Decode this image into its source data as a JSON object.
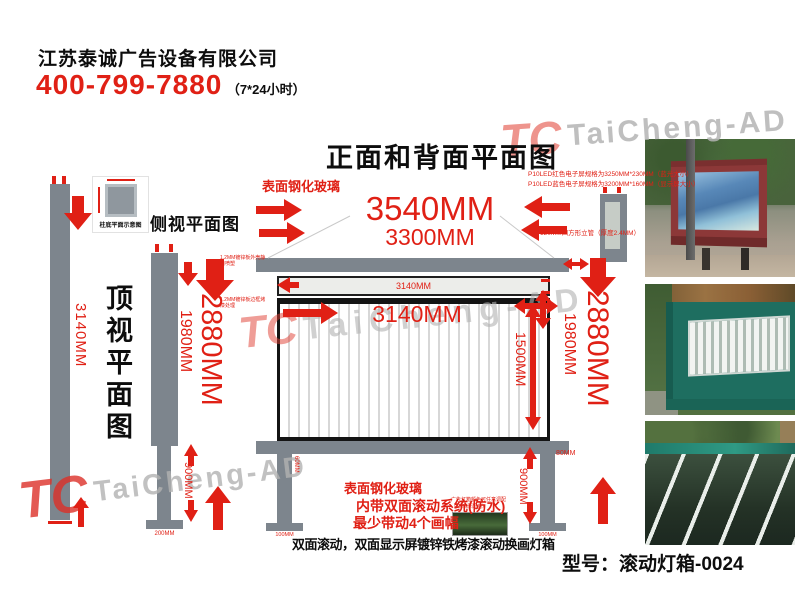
{
  "colors": {
    "accent_red": "#e02015",
    "steel_gray": "#7d858d"
  },
  "header": {
    "company": "江苏泰诚广告设备有限公司",
    "phone": "400-799-7880",
    "hours": "（7*24小时）"
  },
  "title": "正面和背面平面图",
  "watermark": {
    "logo": "TC",
    "brand": "TaiCheng-AD"
  },
  "top_view": {
    "label": "顶视平面图",
    "dim_length": "3140MM",
    "detail_caption": "柱底平面示意图"
  },
  "side_view": {
    "label": "侧视平面图",
    "dim_total_height": "2880MM",
    "dim_box_height": "1980MM",
    "dim_leg_height": "900MM",
    "dim_base": "200MM"
  },
  "front_view": {
    "glass_note": "表面钢化玻璃",
    "dim_total_width": "3540MM",
    "dim_inner_width": "3300MM",
    "dim_led_strip": "3140MM",
    "dim_screen_width": "3140MM",
    "dim_screen_height": "1500MM",
    "dim_total_height": "2880MM",
    "dim_box_height": "1980MM",
    "dim_leg_height": "900MM",
    "dim_frame_depth": "80MM",
    "dim_leg_width": "60MM",
    "dim_base": "100MM",
    "note_led_line1": "P10LED红色电子屏规格为3250MM*230MM（蓝光大小）",
    "note_led_line2": "P10LED蓝色电子屏规格为3200MM*160MM（显示屏大小）",
    "note_pole": "120MM四方形立管（厚度2.4MM）",
    "note_panel_1": "1.2MM镀锌板外壳静电喷塑",
    "note_panel_2": "1.2MM镀锌板边框烤漆处理"
  },
  "bottom_notes": {
    "glass": "表面钢化玻璃",
    "system": "内带双面滚动系统(防水)",
    "frames": "最少带动4个画幅",
    "color_note": "广告灯箱颜色可任意调配（4MM厚配色）",
    "summary": "双面滚动，双面显示屏镀锌铁烤漆滚动换画灯箱"
  },
  "model_label": "型号：滚动灯箱-0024"
}
